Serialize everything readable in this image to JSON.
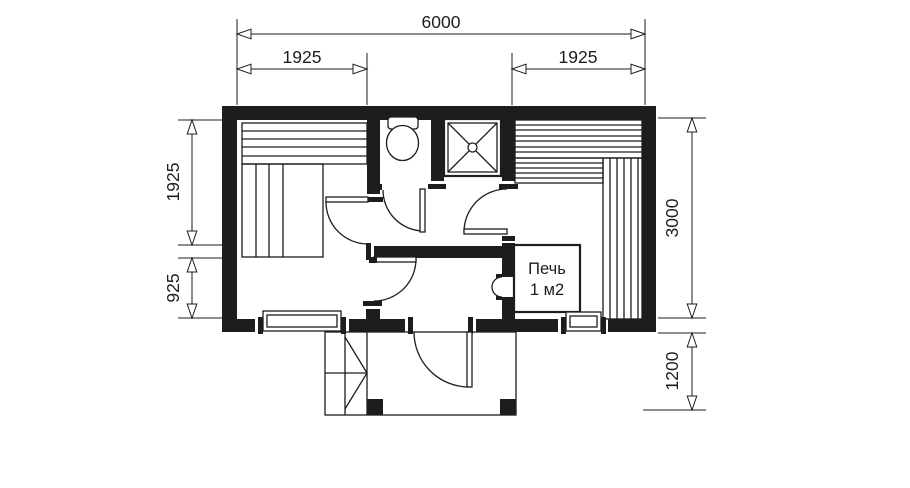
{
  "floor_plan": {
    "dimensions": {
      "width_total": "6000",
      "width_left_room": "1925",
      "width_right_room": "1925",
      "height_left_upper": "1925",
      "height_left_lower": "925",
      "height_main": "3000",
      "porch_depth": "1200"
    },
    "stove": {
      "label_line1": "Печь",
      "label_line2": "1 м2"
    },
    "colors": {
      "ink": "#1d1d1b",
      "background": "#ffffff"
    }
  }
}
